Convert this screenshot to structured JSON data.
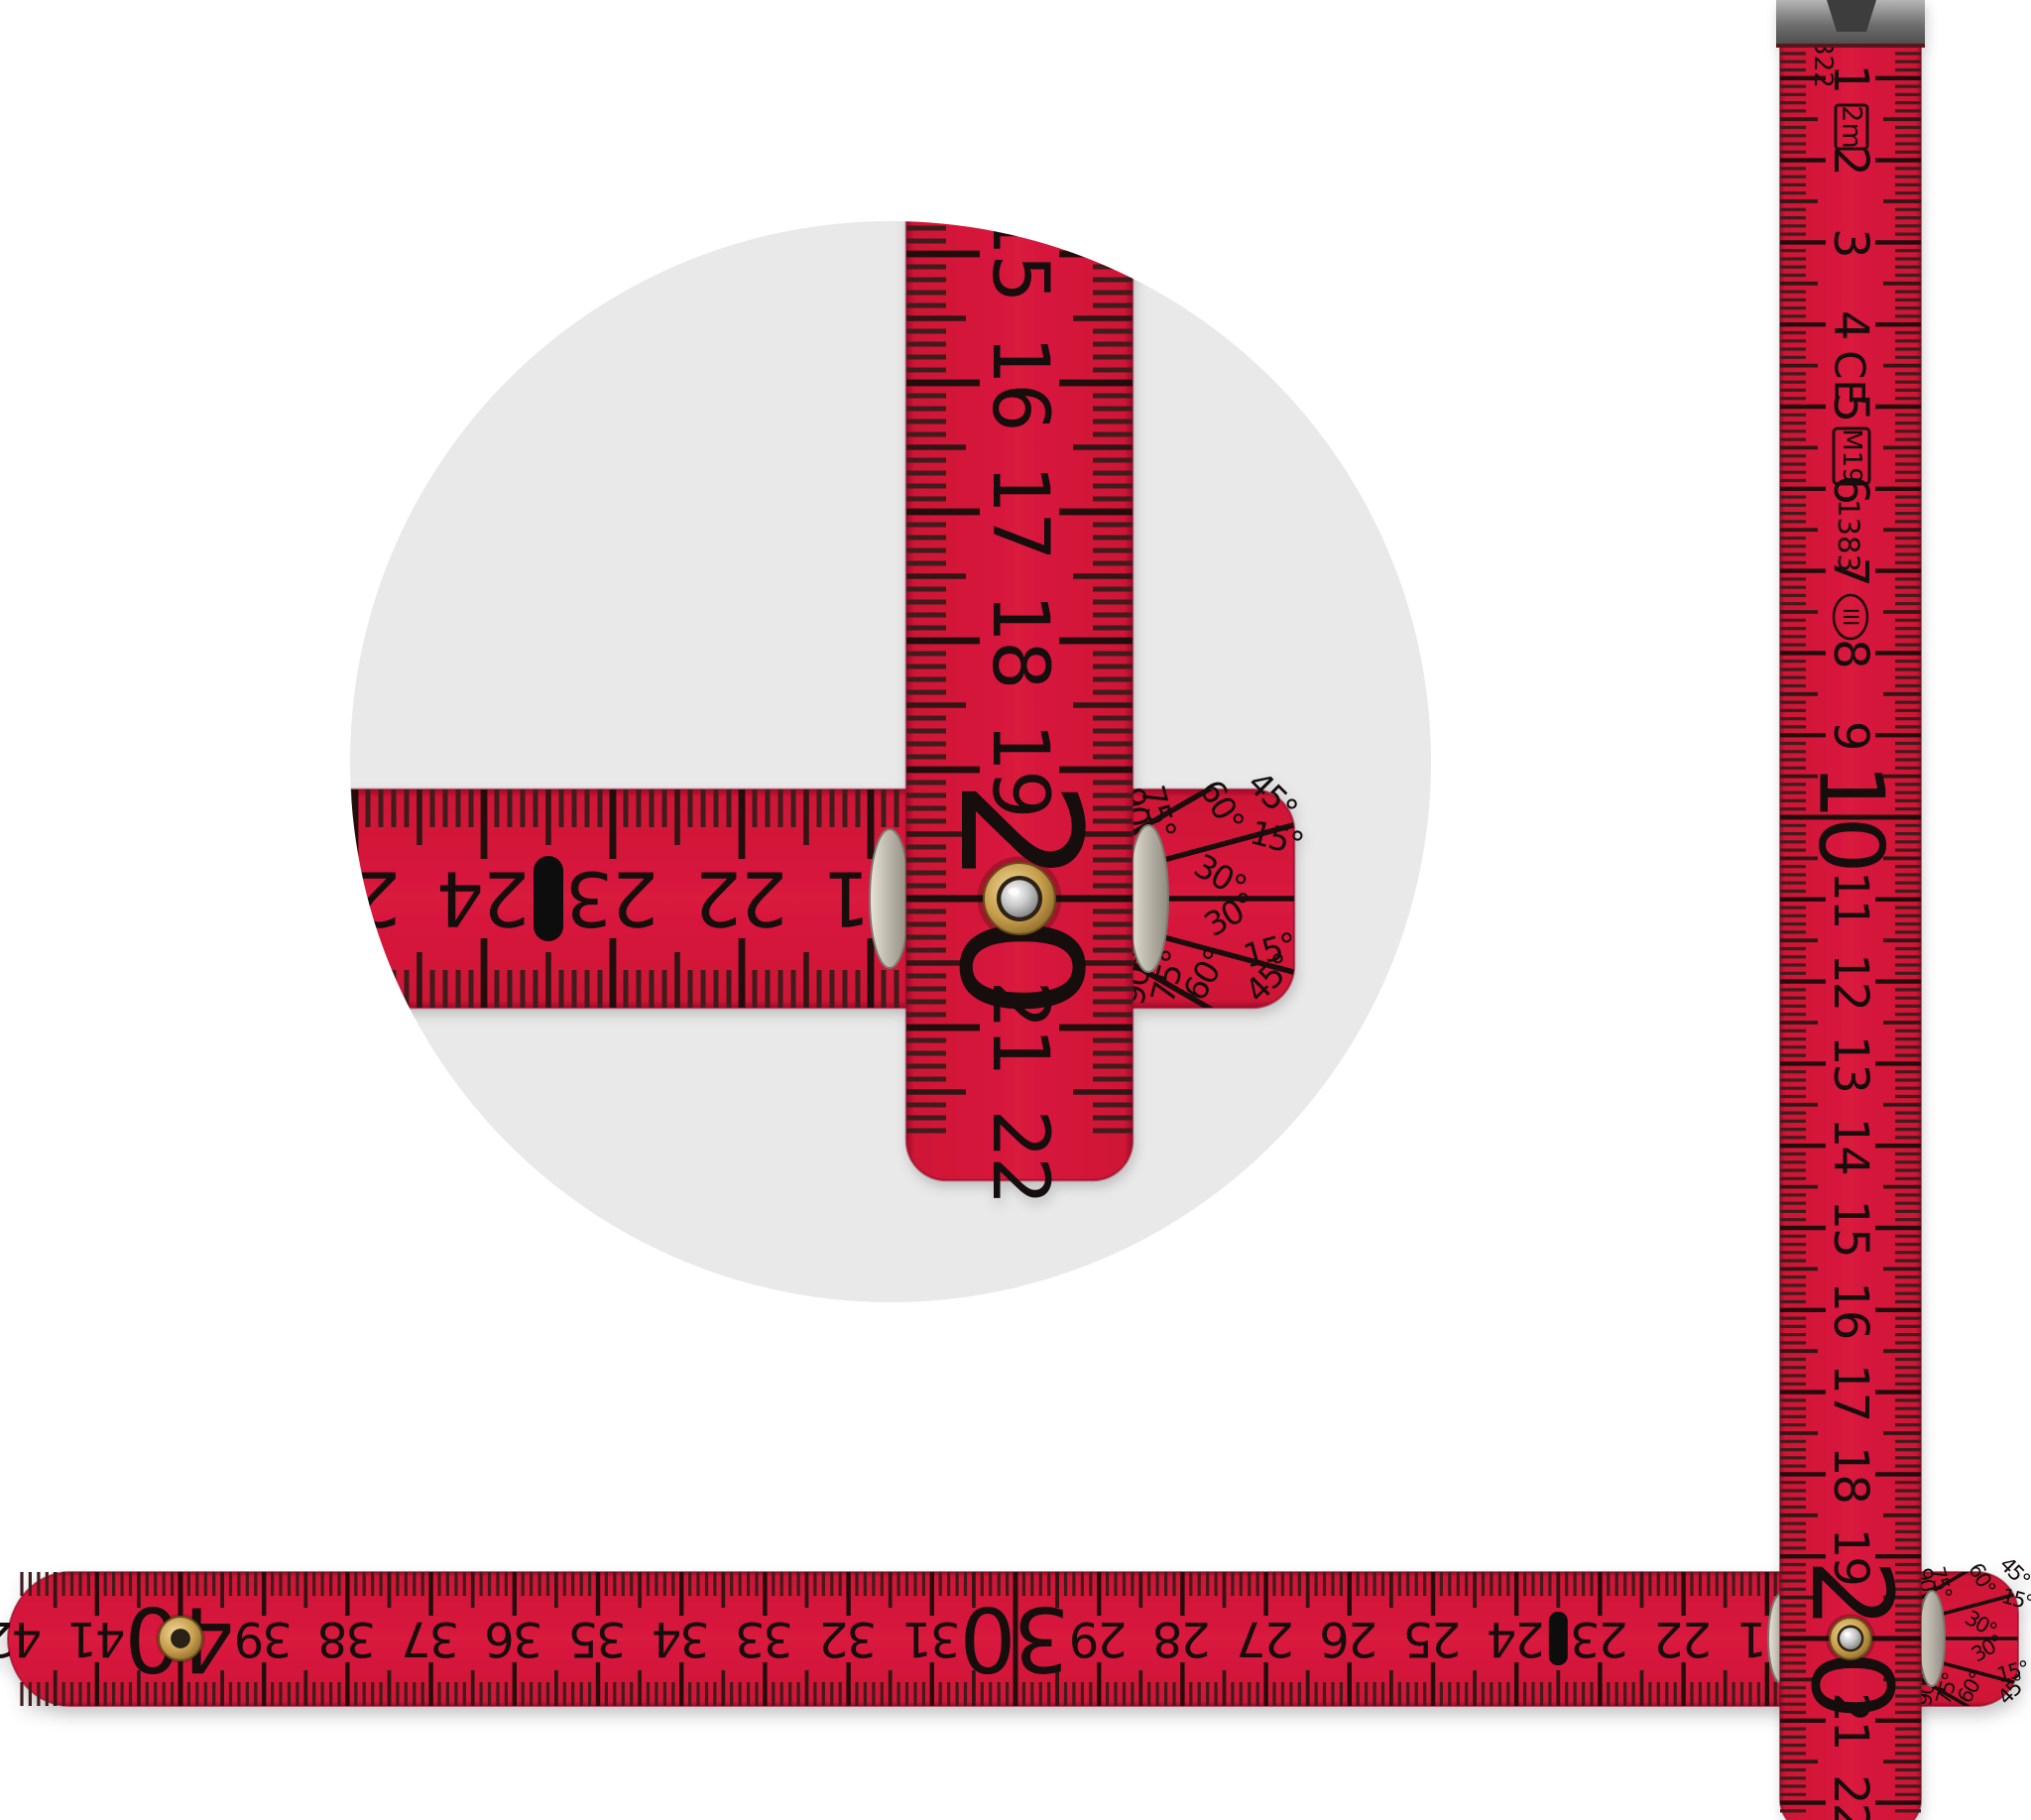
{
  "scene": {
    "subject": "Red 2m folding rule with magnified pivot-joint detail circle"
  },
  "colors": {
    "red": "#d2143a",
    "red_edge": "#a90e2b",
    "circle_bg": "#e9e9e9",
    "tick": "#2a1014",
    "number": "#140a0c",
    "pill": "#0d0d0d",
    "brass": "#c9a152",
    "steel": "#c9c9c9",
    "metal": "#8f8f8f"
  },
  "vertical_ruler": {
    "numbers": [
      "1",
      "2",
      "3",
      "4",
      "5",
      "6",
      "7",
      "8",
      "9",
      "10",
      "11",
      "12",
      "13",
      "14",
      "15",
      "16",
      "17",
      "18",
      "19",
      "20",
      "21",
      "22"
    ],
    "big_numbers": [
      "10",
      "20"
    ],
    "marks": {
      "code": "322",
      "length_badge": "2m",
      "ce": "CE",
      "approval": "M19",
      "standard": "1383",
      "accuracy_class": "III"
    }
  },
  "horizontal_ruler": {
    "numbers": [
      "21",
      "22",
      "23",
      "24",
      "25",
      "26",
      "27",
      "28",
      "29",
      "30",
      "31",
      "32",
      "33",
      "34",
      "35",
      "36",
      "37",
      "38",
      "39",
      "40",
      "41",
      "42"
    ],
    "big_numbers": [
      "30",
      "40"
    ]
  },
  "detail_view": {
    "vertical_numbers": [
      "15",
      "16",
      "17",
      "18",
      "19",
      "20",
      "21",
      "22"
    ],
    "horizontal_numbers": [
      "21",
      "22",
      "23",
      "24",
      "25"
    ],
    "big_number": "20"
  },
  "protractor": {
    "labels": [
      "15°",
      "30°",
      "45°",
      "60°",
      "75°",
      "90°"
    ]
  }
}
